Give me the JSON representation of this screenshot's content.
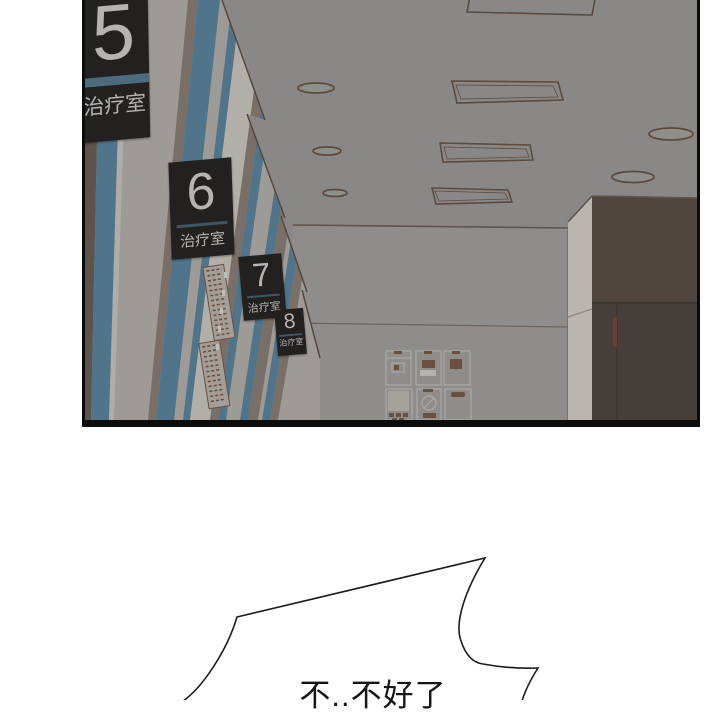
{
  "page": {
    "background": "#ffffff",
    "description": "webtoon comic panel: low-angle view of hospital corridor ceiling with numbered treatment room signs, and a spiky scream speech bubble below"
  },
  "panel": {
    "door_signs": [
      {
        "number": "5",
        "label": "治疗室"
      },
      {
        "number": "6",
        "label": "治疗室"
      },
      {
        "number": "7",
        "label": "治疗室"
      },
      {
        "number": "8",
        "label": "治疗室"
      }
    ],
    "ceiling_lights": {
      "round_downlights": 5,
      "rectangular_panels": 4
    },
    "poster_wall_machines": 6,
    "colors": {
      "ceiling": "#8a8886",
      "far_wall": "#8f8d8a",
      "left_wall": "#9e9b96",
      "door_teal": "#50758a",
      "frame_taupe": "#7a6f66",
      "frame_dark_taupe": "#5d534a",
      "whiteboard": "#b2afa9",
      "poster_brown": "#6b4f3f",
      "outline_brown": "#5c4a3e",
      "right_wall_brown": "#4e463f",
      "right_wall_brown_lower": "#473f39",
      "corner_highlight": "#b9b6b0",
      "sign_background": "#232020",
      "sign_text": "#b6b4b1",
      "sign_divider_teal": "#4c6b7c",
      "panel_border": "#0c0c0c"
    }
  },
  "speech_bubble": {
    "text": "不..不好了",
    "fill": "#ffffff",
    "outline": "#1a1a1a",
    "text_color": "#151515"
  }
}
